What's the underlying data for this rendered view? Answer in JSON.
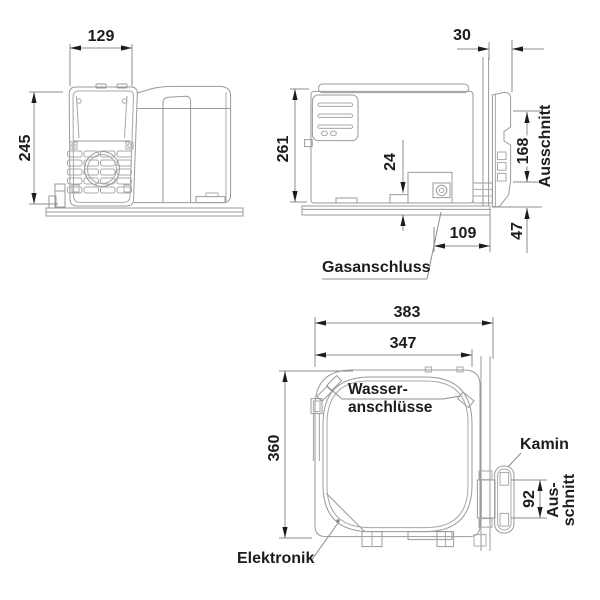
{
  "colors": {
    "background": "#ffffff",
    "device_line": "#9a9a9a",
    "dimension_line": "#8c8c8c",
    "text": "#1c1c1c"
  },
  "front_view": {
    "width_dim": "129",
    "height_dim": "245"
  },
  "side_view": {
    "wall_thickness_dim": "30",
    "height_dim": "261",
    "base_clearance_dim": "24",
    "cutout_height_dim": "168",
    "cutout_label": "Ausschnitt",
    "below_cutout_dim": "47",
    "gas_offset_dim": "109",
    "gas_connection_label": "Gasanschluss"
  },
  "top_view": {
    "overall_width_dim": "383",
    "body_width_dim": "347",
    "depth_dim": "360",
    "water_label_line1": "Wasser-",
    "water_label_line2": "anschlüsse",
    "chimney_label": "Kamin",
    "cutout_width_dim": "92",
    "cutout_label_line1": "Aus-",
    "cutout_label_line2": "schnitt",
    "electronics_label": "Elektronik"
  }
}
